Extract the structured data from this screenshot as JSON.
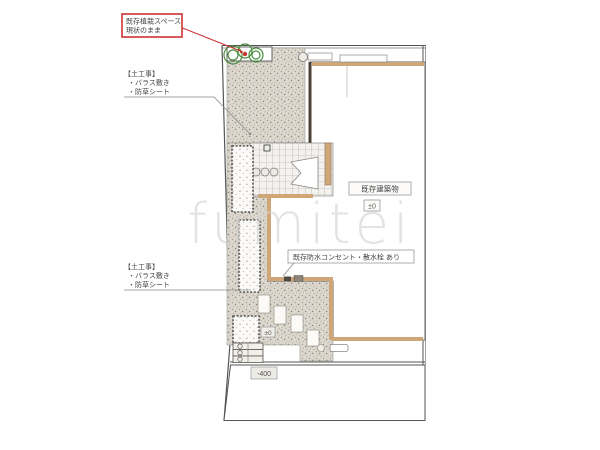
{
  "watermark": "fumitei",
  "labels": {
    "planting_note": {
      "line1": "既存植栽スペース",
      "line2": "現状のまま"
    },
    "earthwork": {
      "title": "【土工事】",
      "item1": "・バラス敷き",
      "item2": "・防草シート"
    },
    "outlet_note": "既存防水コンセント・散水栓 あり",
    "building": "既存建築物",
    "building_level": "±0",
    "garden_level": "±0",
    "lower_level": "-400"
  },
  "colors": {
    "wall_band": "#cfa678",
    "highlight_red": "#cc3333",
    "plant_green": "#4a8f3f",
    "gravel_base": "#ddd8cf",
    "line_dark": "#555555"
  }
}
